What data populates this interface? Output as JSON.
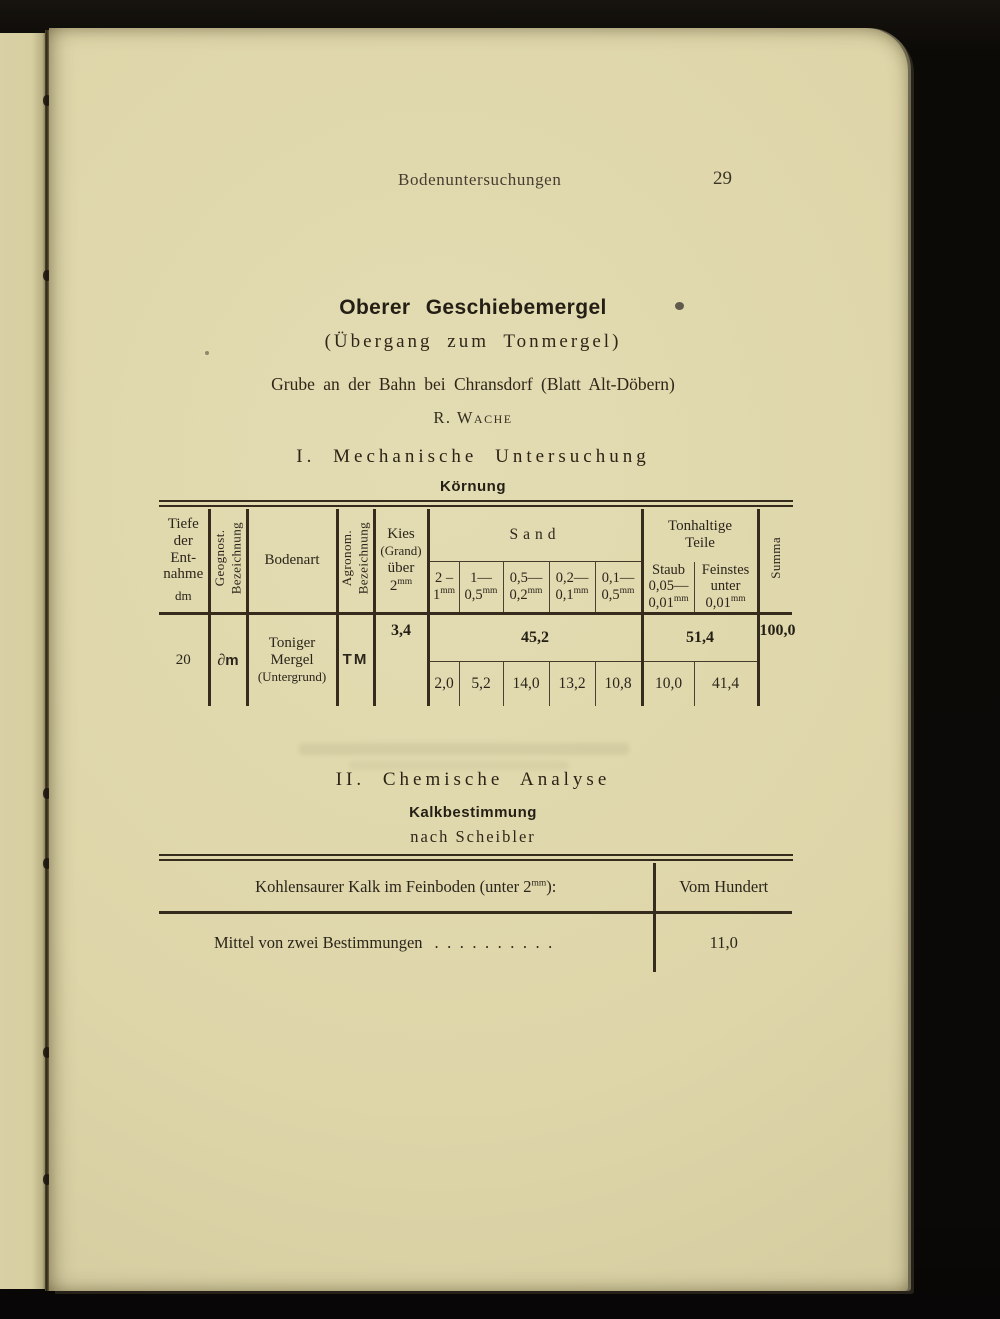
{
  "page": {
    "running_head": "Bodenuntersuchungen",
    "page_number": "29",
    "title": "Oberer Geschiebemergel",
    "subtitle": "(Übergang zum Tonmergel)",
    "location": "Grube an der Bahn bei Chransdorf (Blatt Alt-Döbern)",
    "author": "R. Wache",
    "section1": "I. Mechanische Untersuchung",
    "section1_sub": "Körnung",
    "section2": "II. Chemische Analyse",
    "section2_sub": "Kalkbestimmung",
    "section2_method": "nach Scheibler"
  },
  "grain_table": {
    "col_tiefe": {
      "l1": "Tiefe",
      "l2": "der",
      "l3": "Ent-",
      "l4": "nahme",
      "unit": "dm"
    },
    "col_geognost": {
      "line1": "Geognost.",
      "line2": "Bezeichnung"
    },
    "col_bodenart": "Bodenart",
    "col_agronom": {
      "line1": "Agronom.",
      "line2": "Bezeichnung"
    },
    "col_kies": {
      "l1": "Kies",
      "l2": "(Grand)",
      "l3": "über",
      "l4": "2",
      "sup": "mm"
    },
    "group_sand": "Sand",
    "sand_cols": [
      {
        "t": "2 –",
        "b": "1",
        "sup": "mm"
      },
      {
        "t": "1—",
        "b": "0,5",
        "sup": "mm"
      },
      {
        "t": "0,5—",
        "b": "0,2",
        "sup": "mm"
      },
      {
        "t": "0,2—",
        "b": "0,1",
        "sup": "mm"
      },
      {
        "t": "0,1—",
        "b": "0,5",
        "sup": "mm"
      }
    ],
    "group_ton": {
      "l1": "Tonhaltige",
      "l2": "Teile"
    },
    "ton_cols": [
      {
        "l1": "Staub",
        "l2": "0,05—",
        "b": "0,01",
        "sup": "mm"
      },
      {
        "l1": "Feinstes",
        "l2": "unter",
        "b": "0,01",
        "sup": "mm"
      }
    ],
    "col_summa": "Summa",
    "row": {
      "tiefe": "20",
      "geognost_symbol": "∂",
      "geognost_letter": "m",
      "bodenart_l1": "Toniger",
      "bodenart_l2": "Mergel",
      "bodenart_l3": "(Untergrund)",
      "agronom": "TM",
      "kies": "3,4",
      "sand_total": "45,2",
      "sand_values": [
        "2,0",
        "5,2",
        "14,0",
        "13,2",
        "10,8"
      ],
      "ton_total": "51,4",
      "ton_values": [
        "10,0",
        "41,4"
      ],
      "summa": "100,0"
    }
  },
  "kalk_table": {
    "header_left_pre": "Kohlensaurer Kalk im Feinboden (unter 2",
    "header_left_sup": "mm",
    "header_left_post": "):",
    "header_right": "Vom Hundert",
    "row_label": "Mittel von zwei Bestimmungen",
    "row_dots": "..........",
    "row_value": "11,0"
  }
}
